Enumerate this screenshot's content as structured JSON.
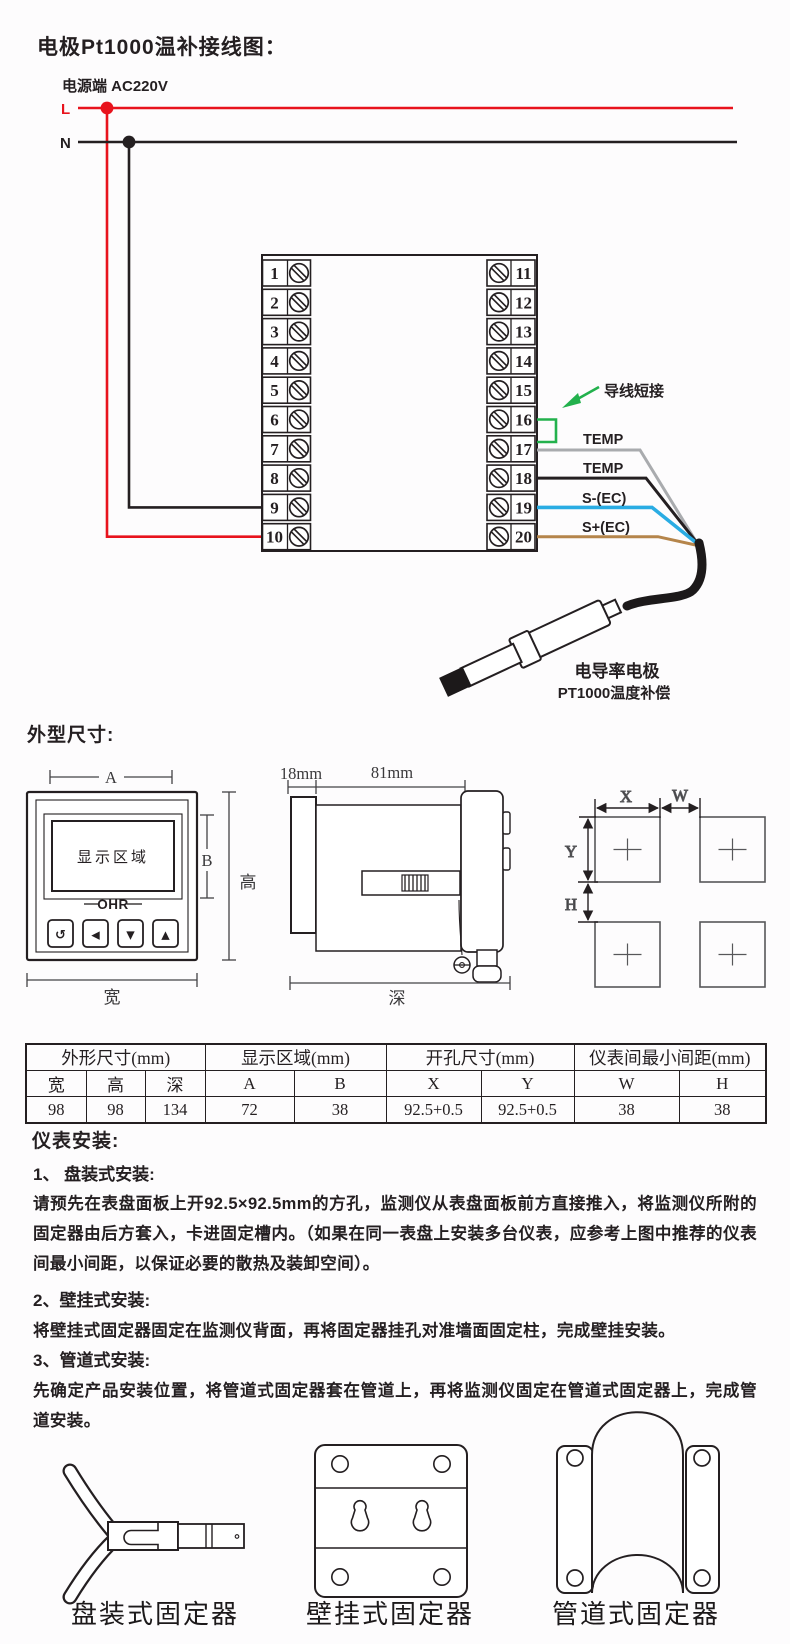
{
  "colors": {
    "red": "#e8131d",
    "green": "#23b14d",
    "blue": "#2aace3",
    "gray": "#a9abae",
    "brown": "#b5854b",
    "ink": "#241f21"
  },
  "wiring": {
    "title": "电极Pt1000温补接线图：",
    "power_label": "电源端  AC220V",
    "line_l": "L",
    "line_n": "N",
    "terminals_left": [
      "1",
      "2",
      "3",
      "4",
      "5",
      "6",
      "7",
      "8",
      "9",
      "10"
    ],
    "terminals_right": [
      "11",
      "12",
      "13",
      "14",
      "15",
      "16",
      "17",
      "18",
      "19",
      "20"
    ],
    "jumper_label": "导线短接",
    "wire_labels": [
      "TEMP",
      "TEMP",
      "S-(EC)",
      "S+(EC)"
    ],
    "electrode_line1": "电导率电极",
    "electrode_line2": "PT1000温度补偿"
  },
  "dims": {
    "heading": "外型尺寸:",
    "front": {
      "a": "A",
      "b": "B",
      "height": "高",
      "width": "宽",
      "display": "显示区域",
      "brand": "OHR",
      "buttons": [
        "↺",
        "◀",
        "▼",
        "▲"
      ]
    },
    "side": {
      "d1": "18mm",
      "d2": "81mm",
      "depth": "深"
    },
    "holes": {
      "x": "X",
      "w": "W",
      "y": "Y",
      "h": "H"
    }
  },
  "table": {
    "groups": [
      "外形尺寸(mm)",
      "显示区域(mm)",
      "开孔尺寸(mm)",
      "仪表间最小间距(mm)"
    ],
    "cols": [
      "宽",
      "高",
      "深",
      "A",
      "B",
      "X",
      "Y",
      "W",
      "H"
    ],
    "values": [
      "98",
      "98",
      "134",
      "72",
      "38",
      "92.5+0.5",
      "92.5+0.5",
      "38",
      "38"
    ]
  },
  "install": {
    "heading": "仪表安装:",
    "items": [
      {
        "title": "1、 盘装式安装:",
        "body": "请预先在表盘面板上开92.5×92.5mm的方孔，监测仪从表盘面板前方直接推入，将监测仪所附的固定器由后方套入，卡进固定槽内。（如果在同一表盘上安装多台仪表，应参考上图中推荐的仪表间最小间距，以保证必要的散热及装卸空间）。"
      },
      {
        "title": "2、壁挂式安装:",
        "body": "将壁挂式固定器固定在监测仪背面，再将固定器挂孔对准墙面固定柱，完成壁挂安装。"
      },
      {
        "title": "3、管道式安装:",
        "body": "先确定产品安装位置，将管道式固定器套在管道上，再将监测仪固定在管道式固定器上，完成管道安装。"
      }
    ]
  },
  "fixtures": {
    "panel": "盘装式固定器",
    "wall": "壁挂式固定器",
    "pipe": "管道式固定器"
  }
}
